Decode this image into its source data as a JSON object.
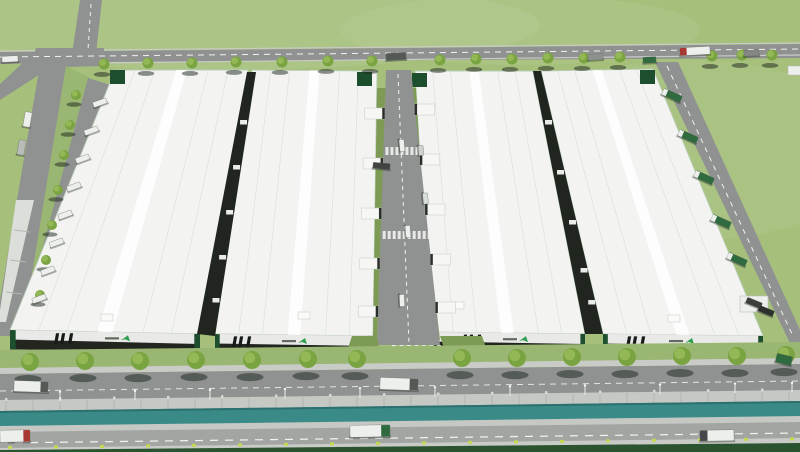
{
  "meta": {
    "alt": "Aerial 3D rendering of an industrial logistics park: four long white-roofed warehouses with dark loading fronts and green brand logos, internal roads with docked trucks, tree-lined streets, a water channel and a main road with trucks in the foreground, surrounded by green fields."
  },
  "colors": {
    "grass": "#a6c07c",
    "grass_light": "#b8cd90",
    "grass_band": "#9ab673",
    "lawn": "#7e9b55",
    "hedge": "#2c5330",
    "tree": "#79a441",
    "tree_light": "#97ba58",
    "road": "#8f9290",
    "road_light": "#a2a5a2",
    "sidewalk": "#c9cbc7",
    "dash": "#f2f3f1",
    "roof": "#f3f4f2",
    "roof_line": "#dbe1da",
    "roof_trim": "#b9cdb6",
    "facade": "#e9eae8",
    "facade_dark": "#22261f",
    "stripe": "#161a18",
    "accent": "#1d4f2e",
    "logo_green": "#2f9e4e",
    "gap_dark": "#20261f",
    "water": "#3a8b88",
    "water_dark": "#2c7170",
    "wall": "#c6c8c4",
    "wall_joint": "#a9aca8",
    "canopy": "#dcded9",
    "dock": "#f6f7f4",
    "dock_dark": "#2a2e29",
    "shadow": "#1c231b",
    "truck_white": "#edefec",
    "truck_red": "#a73832",
    "truck_green": "#2f6b3f",
    "marker": "#c4d851",
    "pole": "#eceeea"
  },
  "scene": {
    "buildings": [
      {
        "pts": [
          [
            115,
            70
          ],
          [
            248,
            70
          ],
          [
            200,
            334
          ],
          [
            10,
            330
          ]
        ],
        "stripe_cx": 65,
        "logo_cx": 118
      },
      {
        "pts": [
          [
            252,
            70
          ],
          [
            377,
            71
          ],
          [
            373,
            336
          ],
          [
            215,
            334
          ]
        ],
        "stripe_cx": 243,
        "logo_cx": 295
      },
      {
        "pts": [
          [
            415,
            71
          ],
          [
            533,
            71
          ],
          [
            585,
            334
          ],
          [
            430,
            332
          ]
        ],
        "stripe_cx": 473,
        "logo_cx": 516
      },
      {
        "pts": [
          [
            541,
            71
          ],
          [
            653,
            69
          ],
          [
            763,
            336
          ],
          [
            603,
            334
          ]
        ],
        "stripe_cx": 637,
        "logo_cx": 682
      }
    ],
    "corner_boxes": [
      [
        110,
        70
      ],
      [
        357,
        72
      ],
      [
        412,
        73
      ],
      [
        640,
        70
      ]
    ],
    "roof_vents": [
      [
        101,
        314
      ],
      [
        298,
        312
      ],
      [
        452,
        302
      ],
      [
        668,
        315
      ]
    ],
    "trees_top": [
      [
        104,
        64
      ],
      [
        148,
        63
      ],
      [
        192,
        63
      ],
      [
        236,
        62
      ],
      [
        282,
        62
      ],
      [
        328,
        61
      ],
      [
        372,
        61
      ],
      [
        440,
        60
      ],
      [
        476,
        59
      ],
      [
        512,
        59
      ],
      [
        548,
        58
      ],
      [
        584,
        58
      ],
      [
        620,
        57
      ],
      [
        712,
        56
      ],
      [
        742,
        55
      ],
      [
        772,
        55
      ]
    ],
    "trees_bottom": [
      [
        30,
        362
      ],
      [
        85,
        361
      ],
      [
        140,
        361
      ],
      [
        196,
        360
      ],
      [
        252,
        360
      ],
      [
        308,
        359
      ],
      [
        357,
        359
      ],
      [
        462,
        358
      ],
      [
        517,
        358
      ],
      [
        572,
        357
      ],
      [
        627,
        357
      ],
      [
        682,
        356
      ],
      [
        737,
        356
      ],
      [
        786,
        355
      ]
    ],
    "median_trees": [
      [
        76,
        95
      ],
      [
        70,
        125
      ],
      [
        64,
        155
      ],
      [
        58,
        190
      ],
      [
        52,
        225
      ],
      [
        46,
        260
      ],
      [
        40,
        295
      ]
    ],
    "central_docks_left_y": [
      108,
      158,
      208,
      258,
      306
    ],
    "central_docks_right_y": [
      104,
      154,
      204,
      254,
      302
    ],
    "gap12_dock_y": [
      120,
      165,
      210,
      255,
      298
    ],
    "gap34_dock_y": [
      120,
      170,
      220,
      268,
      300
    ],
    "apron_truck_ys": [
      100,
      128,
      156,
      184,
      212,
      240,
      268,
      296
    ],
    "pole_xs": [
      60,
      135,
      210,
      285,
      360,
      435,
      510,
      585,
      660,
      735,
      792
    ],
    "trucks": [
      [
        2,
        56,
        16,
        6,
        -3,
        "truck_white",
        null,
        0
      ],
      [
        386,
        53,
        20,
        7,
        -3,
        "#555956",
        null,
        0
      ],
      [
        588,
        54,
        15,
        6,
        -3,
        "#8e928f",
        null,
        0
      ],
      [
        643,
        57,
        13,
        6,
        -3,
        "truck_green",
        null,
        0
      ],
      [
        680,
        47,
        30,
        8,
        -3,
        "truck_white",
        "truck_red",
        -1
      ],
      [
        744,
        50,
        15,
        6,
        -3,
        "#848885",
        null,
        0
      ],
      [
        24,
        112,
        7,
        15,
        10,
        "truck_white",
        null,
        0
      ],
      [
        18,
        140,
        7,
        15,
        10,
        "#b9bcb8",
        null,
        0
      ],
      [
        396,
        143,
        12,
        5,
        85,
        "truck_white",
        null,
        0
      ],
      [
        373,
        163,
        17,
        6,
        5,
        "#3f4441",
        null,
        0
      ],
      [
        416,
        148,
        10,
        5,
        85,
        "#ced2cf",
        null,
        0
      ],
      [
        420,
        196,
        11,
        5,
        85,
        "#dadedb",
        null,
        0
      ],
      [
        402,
        229,
        12,
        5,
        85,
        "truck_white",
        null,
        0
      ],
      [
        396,
        298,
        12,
        5,
        88,
        "truck_white",
        null,
        0
      ],
      [
        662,
        92,
        20,
        7,
        24,
        "truck_green",
        "truck_white",
        -1
      ],
      [
        678,
        133,
        20,
        7,
        24,
        "truck_green",
        "truck_white",
        -1
      ],
      [
        694,
        174,
        20,
        7,
        24,
        "truck_green",
        "truck_white",
        -1
      ],
      [
        711,
        218,
        20,
        7,
        24,
        "truck_green",
        "truck_white",
        -1
      ],
      [
        727,
        256,
        20,
        7,
        24,
        "truck_green",
        "truck_white",
        -1
      ],
      [
        746,
        300,
        16,
        6,
        22,
        "#3a3e3c",
        null,
        0
      ],
      [
        758,
        308,
        16,
        6,
        22,
        "#2d312c",
        null,
        0
      ],
      [
        776,
        355,
        16,
        9,
        14,
        "truck_green",
        null,
        0
      ],
      [
        14,
        381,
        34,
        11,
        2,
        "truck_white",
        "#555956",
        1
      ],
      [
        380,
        378,
        38,
        12,
        2,
        "truck_white",
        "#555956",
        1
      ],
      [
        0,
        430,
        30,
        12,
        -1,
        "truck_white",
        "truck_red",
        1
      ],
      [
        350,
        425,
        40,
        12,
        -1,
        "truck_white",
        "truck_green",
        1
      ],
      [
        700,
        430,
        34,
        11,
        -1,
        "truck_white",
        "#45494a",
        -1
      ]
    ]
  }
}
